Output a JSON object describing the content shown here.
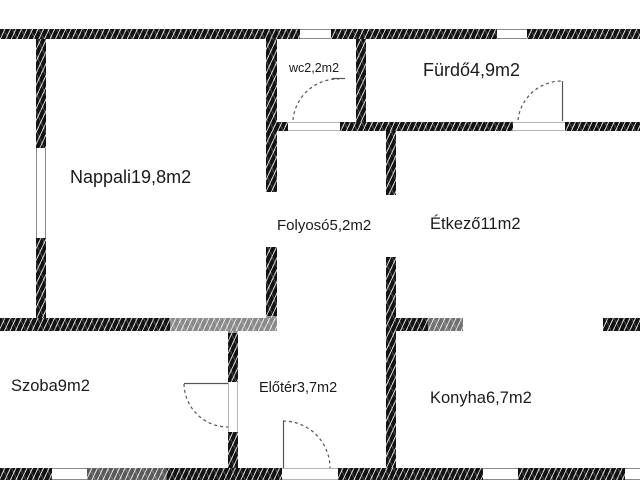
{
  "floorplan": {
    "rooms": [
      {
        "id": "nappali",
        "label": "Nappali19,8m2"
      },
      {
        "id": "wc",
        "label": "wc2,2m2"
      },
      {
        "id": "furdo",
        "label": "Fürdő4,9m2"
      },
      {
        "id": "folyoso",
        "label": "Folyosó5,2m2"
      },
      {
        "id": "etkezo",
        "label": "Étkező11m2"
      },
      {
        "id": "szoba",
        "label": "Szoba9m2"
      },
      {
        "id": "eloter",
        "label": "Előtér3,7m2"
      },
      {
        "id": "konyha",
        "label": "Konyha6,7m2"
      }
    ],
    "colors": {
      "wall": "#131313",
      "hatch_line": "#cccccc",
      "thin_line": "#555555",
      "text": "#1b1b1b",
      "background": "#ffffff"
    }
  }
}
